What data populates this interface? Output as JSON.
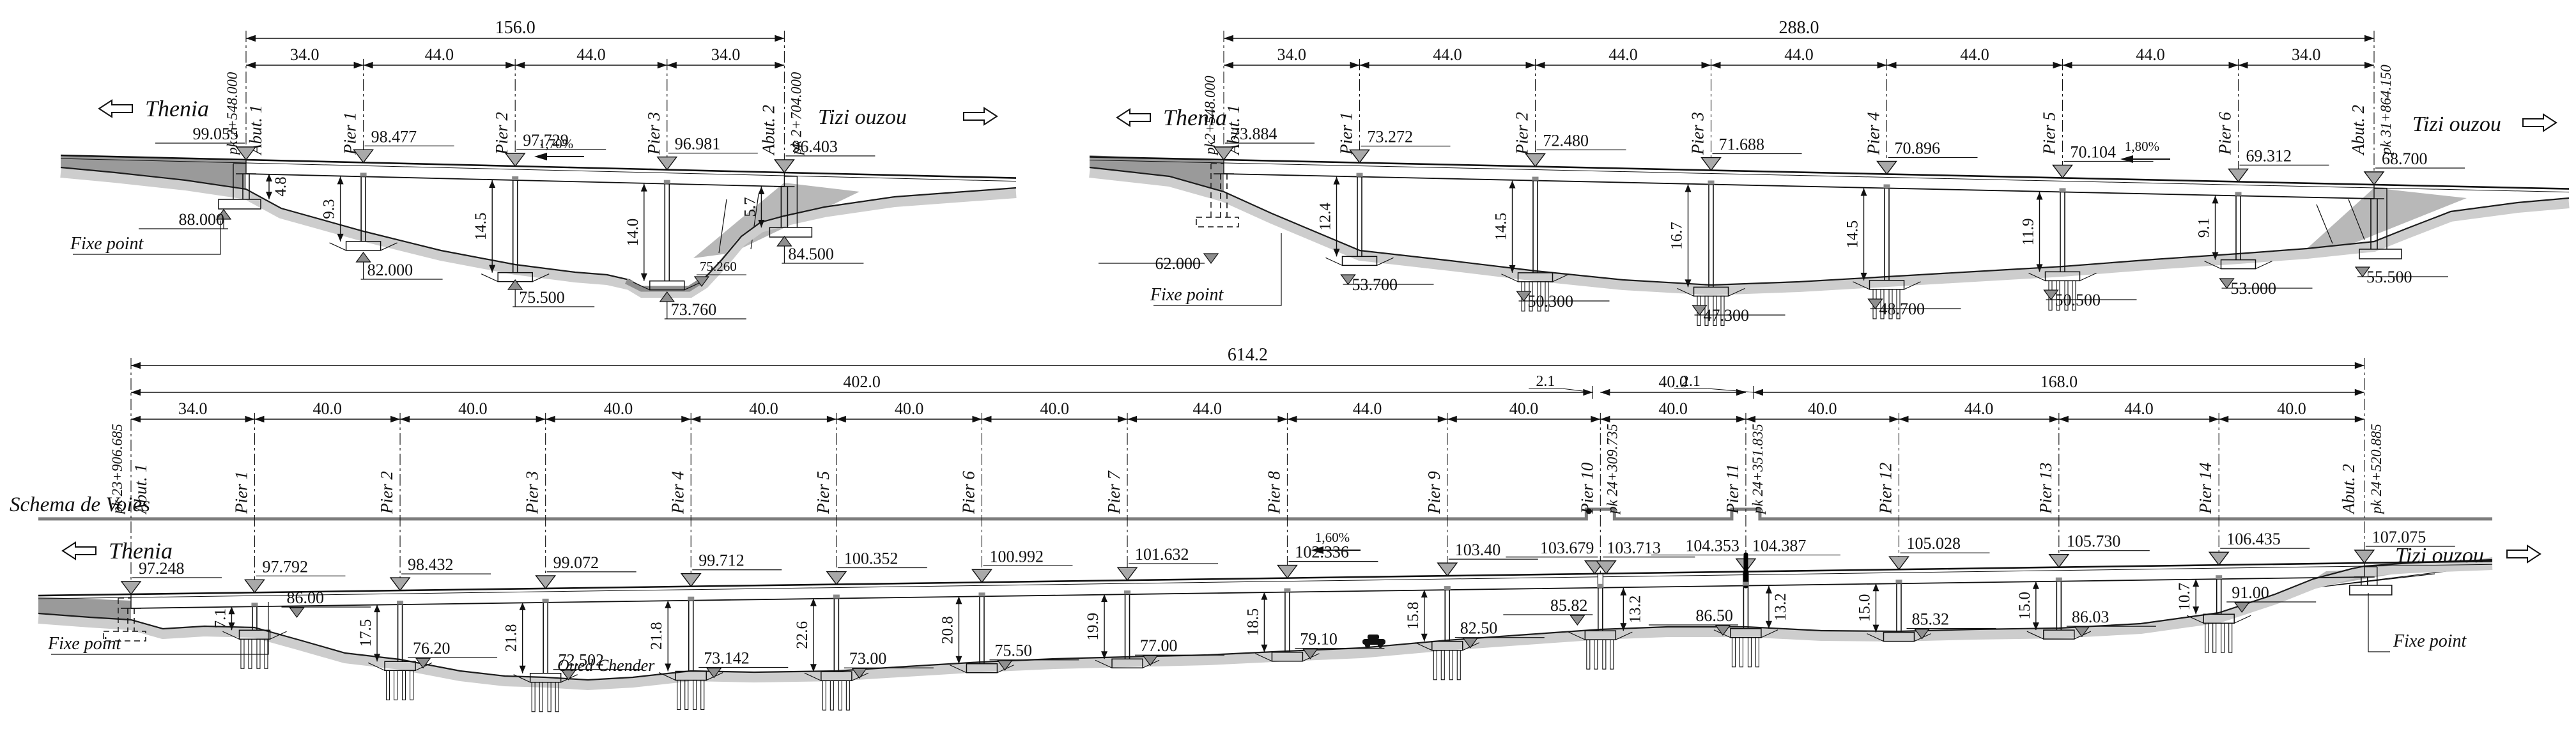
{
  "title": "Viaduct longitudinal elevation schematics (Thenia - Tizi ouzou line)",
  "colors": {
    "ink": "#111111",
    "ground_band": "#cdcdcd",
    "embankment_dark": "#9a9a9a",
    "embankment_wedge": "#b8b8b8",
    "marker_gray": "#8f8f8f",
    "bearing_gray": "#a9a9a9",
    "schema_line": "#7d7d7d",
    "schema_text": "#8a8a8a"
  },
  "bridges": [
    {
      "id": "viaduct-a",
      "total_length": "156.0",
      "direction_left": "Thenia",
      "direction_right": "Tizi ouzou",
      "slope_label": "1,70%",
      "fixe_point_label": "Fixe point",
      "extra_level_label": "75.260",
      "axes": [
        {
          "name": "Abut. 1",
          "pk": "pk 2+548.000",
          "deck_level": "99.055",
          "height": "4.8",
          "foundation_level": "88.000",
          "span_to_next": "34.0"
        },
        {
          "name": "Pier 1",
          "deck_level": "98.477",
          "height": "9.3",
          "foundation_level": "82.000",
          "span_to_next": "44.0"
        },
        {
          "name": "Pier 2",
          "deck_level": "97.729",
          "height": "14.5",
          "foundation_level": "75.500",
          "span_to_next": "44.0"
        },
        {
          "name": "Pier 3",
          "deck_level": "96.981",
          "height": "14.0",
          "foundation_level": "73.760",
          "span_to_next": "34.0"
        },
        {
          "name": "Abut. 2",
          "pk": "pk 2+704.000",
          "deck_level": "96.403",
          "height": "5.7",
          "foundation_level": "84.500"
        }
      ]
    },
    {
      "id": "viaduct-b",
      "total_length": "288.0",
      "direction_left": "Thenia",
      "direction_right": "Tizi ouzou",
      "slope_label": "1,80%",
      "fixe_point_label": "Fixe point",
      "axes": [
        {
          "name": "Abut. 1",
          "pk": "pk2+548.000",
          "deck_level": "73.884",
          "foundation_level": "62.000",
          "span_to_next": "34.0"
        },
        {
          "name": "Pier 1",
          "deck_level": "73.272",
          "height": "12.4",
          "foundation_level": "53.700",
          "span_to_next": "44.0"
        },
        {
          "name": "Pier 2",
          "deck_level": "72.480",
          "height": "14.5",
          "foundation_level": "50.300",
          "piles": true,
          "span_to_next": "44.0"
        },
        {
          "name": "Pier 3",
          "deck_level": "71.688",
          "height": "16.7",
          "foundation_level": "47.300",
          "piles": true,
          "span_to_next": "44.0"
        },
        {
          "name": "Pier 4",
          "deck_level": "70.896",
          "height": "14.5",
          "foundation_level": "48.700",
          "piles": true,
          "span_to_next": "44.0"
        },
        {
          "name": "Pier 5",
          "deck_level": "70.104",
          "height": "11.9",
          "foundation_level": "50.500",
          "piles": true,
          "span_to_next": "44.0"
        },
        {
          "name": "Pier 6",
          "deck_level": "69.312",
          "height": "9.1",
          "foundation_level": "53.000",
          "span_to_next": "34.0"
        },
        {
          "name": "Abut. 2",
          "pk": "pk 31+864.150",
          "deck_level": "68.700",
          "foundation_level": "55.500"
        }
      ]
    },
    {
      "id": "viaduct-c",
      "total_length": "614.2",
      "section_lengths": [
        "402.0",
        "40.0",
        "168.0"
      ],
      "joint_offset_label": "2.1",
      "schema_label": "Schema de Voies",
      "watercourse_label": "Oued Chender",
      "direction_left": "Thenia",
      "direction_right": "Tizi ouzou",
      "slope_label": "1,60%",
      "fixe_point_label": "Fixe point",
      "axes": [
        {
          "name": "Abut. 1",
          "pk": "pk 23+906.685",
          "deck_level": "97.248",
          "span_to_next": "34.0"
        },
        {
          "name": "Pier 1",
          "deck_level": "97.792",
          "height": "7.1",
          "foundation_level": "86.00",
          "piles": true,
          "span_to_next": "40.0"
        },
        {
          "name": "Pier 2",
          "deck_level": "98.432",
          "height": "17.5",
          "foundation_level": "76.20",
          "piles": true,
          "span_to_next": "40.0"
        },
        {
          "name": "Pier 3",
          "deck_level": "99.072",
          "height": "21.8",
          "foundation_level": "72.502",
          "piles": true,
          "span_to_next": "40.0"
        },
        {
          "name": "Pier 4",
          "deck_level": "99.712",
          "height": "21.8",
          "foundation_level": "73.142",
          "piles": true,
          "span_to_next": "40.0"
        },
        {
          "name": "Pier 5",
          "deck_level": "100.352",
          "height": "22.6",
          "foundation_level": "73.00",
          "piles": true,
          "span_to_next": "40.0"
        },
        {
          "name": "Pier 6",
          "deck_level": "100.992",
          "height": "20.8",
          "foundation_level": "75.50",
          "span_to_next": "40.0"
        },
        {
          "name": "Pier 7",
          "deck_level": "101.632",
          "height": "19.9",
          "foundation_level": "77.00",
          "span_to_next": "44.0"
        },
        {
          "name": "Pier 8",
          "deck_level": "102.336",
          "height": "18.5",
          "foundation_level": "79.10",
          "span_to_next": "44.0"
        },
        {
          "name": "Pier 9",
          "deck_level": "103.40",
          "height": "15.8",
          "foundation_level": "82.50",
          "piles": true,
          "span_to_next": "40.0"
        },
        {
          "name": "Pier 10",
          "pk": "pk 24+309.735",
          "deck_level": "103.679",
          "deck_level_right": "103.713",
          "height": "13.2",
          "foundation_level": "85.82",
          "piles": true,
          "span_to_next": "40.0"
        },
        {
          "name": "Pier 11",
          "pk": "pk 24+351.835",
          "deck_level": "104.353",
          "deck_level_right": "104.387",
          "height": "13.2",
          "foundation_level": "86.50",
          "piles": true,
          "span_to_next": "40.0"
        },
        {
          "name": "Pier 12",
          "deck_level": "105.028",
          "height": "15.0",
          "foundation_level": "85.32",
          "span_to_next": "44.0"
        },
        {
          "name": "Pier 13",
          "deck_level": "105.730",
          "height": "15.0",
          "foundation_level": "86.03",
          "span_to_next": "44.0"
        },
        {
          "name": "Pier 14",
          "deck_level": "106.435",
          "height": "10.7",
          "foundation_level": "91.00",
          "piles": true,
          "span_to_next": "40.0"
        },
        {
          "name": "Abut. 2",
          "pk": "pk 24+520.885",
          "deck_level": "107.075"
        }
      ]
    }
  ]
}
